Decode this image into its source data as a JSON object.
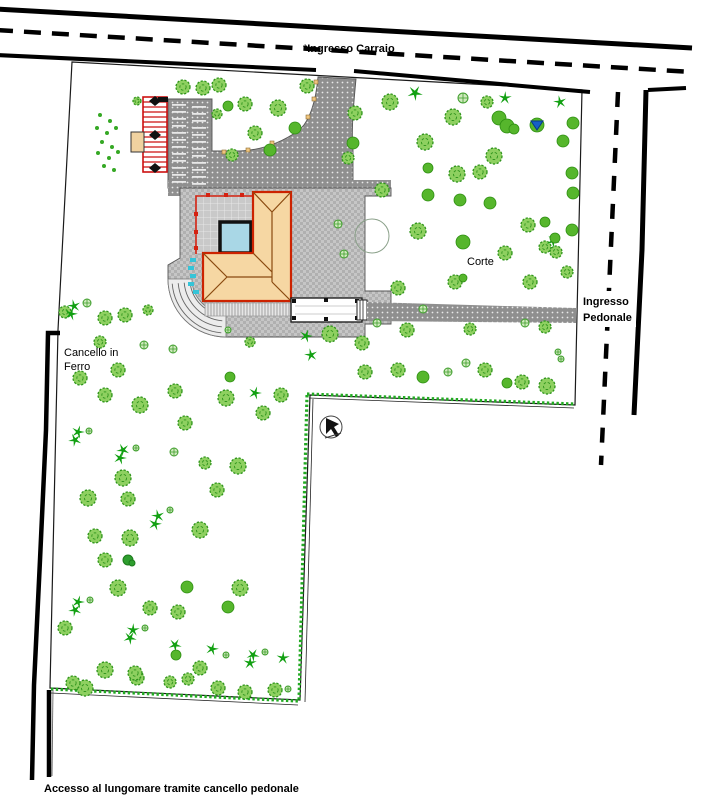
{
  "labels": {
    "ingresso_carraio": "*Ingresso Carraio",
    "ingresso_pedonale_line1": "Ingresso",
    "ingresso_pedonale_line2": "Pedonale",
    "cancello_line1": "Cancello in",
    "cancello_line2": "Ferro",
    "corte": "Corte",
    "accesso": "Accesso al lungomare tramite cancello pedonale"
  },
  "colors": {
    "road": "#000000",
    "pavement_gray": "#8f8f8f",
    "surround_gray": "#bdbdbd",
    "roof_tan": "#f6d7a3",
    "roof_outline_red": "#cc2200",
    "ridge_brown": "#8a4a10",
    "pool_blue": "#a9d7e6",
    "hedge_green": "#22aa22",
    "tree_round": "#56b62c",
    "tree_detail": "#8ed060",
    "tree_detail_stroke": "#2f941c",
    "palm_green": "#12a012",
    "shrub_fill": "#cfe9bd",
    "cyan_marks": "#35c4d8",
    "marker_tan": "#efc57f",
    "blue_flag": "#1560c8"
  },
  "tree_legend": {
    "d": "detail-tree",
    "r": "round-tree",
    "p": "palm-tree",
    "s": "shrub",
    "k": "dark-shrub-cluster",
    "o": "ground-dot"
  },
  "trees": [
    [
      "d",
      183,
      87,
      7
    ],
    [
      "d",
      203,
      88,
      7
    ],
    [
      "d",
      219,
      85,
      7
    ],
    [
      "r",
      228,
      106,
      5
    ],
    [
      "d",
      137,
      101,
      4
    ],
    [
      "d",
      278,
      108,
      8
    ],
    [
      "d",
      307,
      86,
      7
    ],
    [
      "d",
      245,
      104,
      7
    ],
    [
      "r",
      295,
      128,
      6
    ],
    [
      "d",
      255,
      133,
      7
    ],
    [
      "r",
      270,
      150,
      6
    ],
    [
      "d",
      232,
      155,
      6
    ],
    [
      "d",
      217,
      114,
      5
    ],
    [
      "p",
      415,
      93,
      7
    ],
    [
      "d",
      390,
      102,
      8
    ],
    [
      "s",
      463,
      98,
      5
    ],
    [
      "d",
      487,
      102,
      6
    ],
    [
      "p",
      505,
      98,
      6
    ],
    [
      "p",
      560,
      102,
      6
    ],
    [
      "r",
      499,
      118,
      7
    ],
    [
      "r",
      507,
      126,
      7
    ],
    [
      "r",
      514,
      129,
      5
    ],
    [
      "r",
      537,
      125,
      7
    ],
    [
      "r",
      573,
      123,
      6
    ],
    [
      "d",
      355,
      113,
      7
    ],
    [
      "d",
      453,
      117,
      8
    ],
    [
      "r",
      563,
      141,
      6
    ],
    [
      "d",
      425,
      142,
      8
    ],
    [
      "r",
      572,
      173,
      6
    ],
    [
      "d",
      494,
      156,
      8
    ],
    [
      "d",
      457,
      174,
      8
    ],
    [
      "r",
      428,
      168,
      5
    ],
    [
      "d",
      480,
      172,
      7
    ],
    [
      "r",
      573,
      193,
      6
    ],
    [
      "d",
      382,
      190,
      7
    ],
    [
      "r",
      428,
      195,
      6
    ],
    [
      "r",
      460,
      200,
      6
    ],
    [
      "r",
      490,
      203,
      6
    ],
    [
      "d",
      418,
      231,
      8
    ],
    [
      "r",
      463,
      242,
      7
    ],
    [
      "d",
      505,
      253,
      7
    ],
    [
      "d",
      545,
      247,
      6
    ],
    [
      "d",
      556,
      252,
      6
    ],
    [
      "p",
      553,
      241,
      6
    ],
    [
      "d",
      567,
      272,
      6
    ],
    [
      "d",
      455,
      282,
      7
    ],
    [
      "d",
      530,
      282,
      7
    ],
    [
      "r",
      463,
      278,
      4
    ],
    [
      "d",
      398,
      288,
      7
    ],
    [
      "d",
      528,
      225,
      7
    ],
    [
      "r",
      545,
      222,
      5
    ],
    [
      "r",
      555,
      238,
      5
    ],
    [
      "r",
      572,
      230,
      6
    ],
    [
      "d",
      348,
      158,
      6
    ],
    [
      "r",
      353,
      143,
      6
    ],
    [
      "d",
      330,
      334,
      8
    ],
    [
      "d",
      362,
      343,
      7
    ],
    [
      "d",
      407,
      330,
      7
    ],
    [
      "d",
      470,
      329,
      6
    ],
    [
      "s",
      377,
      323,
      4
    ],
    [
      "s",
      423,
      309,
      4
    ],
    [
      "s",
      525,
      323,
      4
    ],
    [
      "d",
      545,
      327,
      6
    ],
    [
      "p",
      306,
      336,
      6
    ],
    [
      "p",
      311,
      355,
      6
    ],
    [
      "d",
      365,
      372,
      7
    ],
    [
      "d",
      398,
      370,
      7
    ],
    [
      "r",
      423,
      377,
      6
    ],
    [
      "s",
      448,
      372,
      4
    ],
    [
      "s",
      466,
      363,
      4
    ],
    [
      "d",
      485,
      370,
      7
    ],
    [
      "r",
      507,
      383,
      5
    ],
    [
      "d",
      522,
      382,
      7
    ],
    [
      "d",
      547,
      386,
      8
    ],
    [
      "s",
      558,
      352,
      3
    ],
    [
      "s",
      561,
      359,
      3
    ],
    [
      "s",
      338,
      224,
      4
    ],
    [
      "s",
      344,
      254,
      4
    ],
    [
      "d",
      65,
      312,
      6
    ],
    [
      "d",
      105,
      318,
      7
    ],
    [
      "d",
      125,
      315,
      7
    ],
    [
      "d",
      148,
      310,
      5
    ],
    [
      "d",
      100,
      342,
      6
    ],
    [
      "s",
      144,
      345,
      4
    ],
    [
      "d",
      118,
      370,
      7
    ],
    [
      "d",
      80,
      378,
      7
    ],
    [
      "d",
      105,
      395,
      7
    ],
    [
      "s",
      173,
      349,
      4
    ],
    [
      "r",
      230,
      377,
      5
    ],
    [
      "d",
      250,
      342,
      5
    ],
    [
      "s",
      228,
      330,
      3
    ],
    [
      "p",
      74,
      306,
      6
    ],
    [
      "p",
      71,
      314,
      6
    ],
    [
      "s",
      87,
      303,
      4
    ],
    [
      "d",
      140,
      405,
      8
    ],
    [
      "d",
      175,
      391,
      7
    ],
    [
      "d",
      226,
      398,
      8
    ],
    [
      "p",
      255,
      393,
      6
    ],
    [
      "d",
      281,
      395,
      7
    ],
    [
      "d",
      263,
      413,
      7
    ],
    [
      "p",
      78,
      432,
      6
    ],
    [
      "p",
      75,
      440,
      6
    ],
    [
      "s",
      89,
      431,
      3
    ],
    [
      "p",
      123,
      450,
      6
    ],
    [
      "p",
      120,
      458,
      6
    ],
    [
      "s",
      136,
      448,
      3
    ],
    [
      "d",
      185,
      423,
      7
    ],
    [
      "d",
      238,
      466,
      8
    ],
    [
      "d",
      205,
      463,
      6
    ],
    [
      "s",
      174,
      452,
      4
    ],
    [
      "d",
      123,
      478,
      8
    ],
    [
      "d",
      88,
      498,
      8
    ],
    [
      "d",
      128,
      499,
      7
    ],
    [
      "d",
      217,
      490,
      7
    ],
    [
      "p",
      158,
      516,
      6
    ],
    [
      "p",
      155,
      524,
      6
    ],
    [
      "s",
      170,
      510,
      3
    ],
    [
      "d",
      200,
      530,
      8
    ],
    [
      "d",
      130,
      538,
      8
    ],
    [
      "d",
      95,
      536,
      7
    ],
    [
      "d",
      105,
      560,
      7
    ],
    [
      "k",
      128,
      560,
      5
    ],
    [
      "d",
      118,
      588,
      8
    ],
    [
      "r",
      187,
      587,
      6
    ],
    [
      "p",
      78,
      602,
      6
    ],
    [
      "p",
      75,
      610,
      6
    ],
    [
      "s",
      90,
      600,
      3
    ],
    [
      "d",
      150,
      608,
      7
    ],
    [
      "d",
      178,
      612,
      7
    ],
    [
      "d",
      240,
      588,
      8
    ],
    [
      "r",
      228,
      607,
      6
    ],
    [
      "p",
      133,
      630,
      6
    ],
    [
      "p",
      130,
      638,
      6
    ],
    [
      "s",
      145,
      628,
      3
    ],
    [
      "p",
      175,
      645,
      6
    ],
    [
      "d",
      65,
      628,
      7
    ],
    [
      "d",
      105,
      670,
      8
    ],
    [
      "d",
      200,
      668,
      7
    ],
    [
      "d",
      137,
      678,
      7
    ],
    [
      "p",
      212,
      649,
      6
    ],
    [
      "p",
      253,
      655,
      6
    ],
    [
      "p",
      250,
      663,
      6
    ],
    [
      "s",
      265,
      652,
      3
    ],
    [
      "d",
      85,
      688,
      8
    ],
    [
      "d",
      73,
      683,
      7
    ],
    [
      "d",
      135,
      673,
      7
    ],
    [
      "d",
      170,
      682,
      6
    ],
    [
      "d",
      188,
      679,
      6
    ],
    [
      "d",
      218,
      688,
      7
    ],
    [
      "d",
      245,
      692,
      7
    ],
    [
      "d",
      275,
      690,
      7
    ],
    [
      "p",
      283,
      658,
      6
    ],
    [
      "s",
      226,
      655,
      3
    ],
    [
      "s",
      288,
      689,
      3
    ],
    [
      "r",
      176,
      655,
      5
    ],
    [
      "o",
      100,
      115,
      2
    ],
    [
      "o",
      110,
      121,
      2
    ],
    [
      "o",
      97,
      128,
      2
    ],
    [
      "o",
      107,
      133,
      2
    ],
    [
      "o",
      116,
      128,
      2
    ],
    [
      "o",
      102,
      142,
      2
    ],
    [
      "o",
      112,
      147,
      2
    ],
    [
      "o",
      98,
      153,
      2
    ],
    [
      "o",
      109,
      158,
      2
    ],
    [
      "o",
      118,
      152,
      2
    ],
    [
      "o",
      104,
      166,
      2
    ],
    [
      "o",
      114,
      170,
      2
    ]
  ],
  "lamp_markers": [
    [
      224,
      152
    ],
    [
      248,
      150
    ],
    [
      272,
      143
    ],
    [
      295,
      131
    ],
    [
      308,
      117
    ],
    [
      314,
      99
    ],
    [
      316,
      82
    ]
  ],
  "special_trees": {
    "outlined_circle": {
      "x": 372,
      "y": 236,
      "r": 17
    },
    "blue_flag_tree": {
      "x": 537,
      "y": 125
    }
  }
}
